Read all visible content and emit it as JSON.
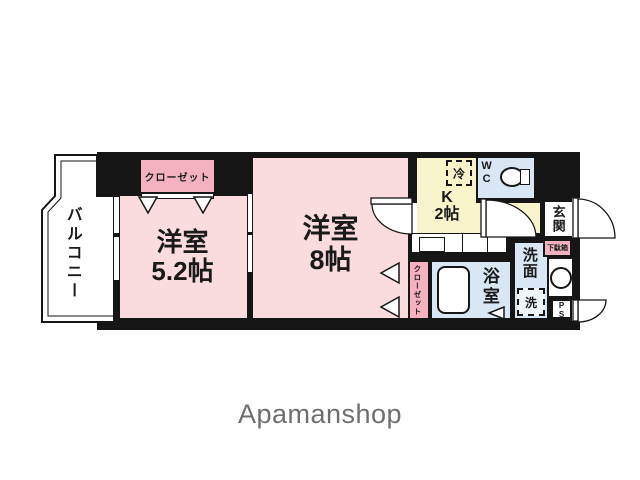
{
  "brand": {
    "logo_text": "Apamanshop"
  },
  "colors": {
    "wall": "#161616",
    "room_pink": "#fbdcde",
    "closet_pink": "#f4b2c1",
    "kitchen_yellow": "#f7f4cc",
    "water_blue": "#d8e7f3",
    "brand_gray": "#6e6e6e"
  },
  "floorplan": {
    "balcony_label": "バルコニー",
    "rooms": {
      "western1": {
        "name": "洋室",
        "size": "5.2帖"
      },
      "western2": {
        "name": "洋室",
        "size": "8帖"
      },
      "kitchen": {
        "name": "K",
        "size": "2帖"
      },
      "wc": {
        "name": "WC"
      },
      "genkan": {
        "name": "玄関"
      },
      "senmen": {
        "name": "洗面"
      },
      "bath": {
        "name": "浴室"
      }
    },
    "fixtures": {
      "closet_top": "クローゼット",
      "closet_side": "クローゼット",
      "refrigerator": "冷",
      "washing_machine": "洗",
      "shoe_cabinet": "下駄箱",
      "pipe_space": "PS"
    }
  }
}
